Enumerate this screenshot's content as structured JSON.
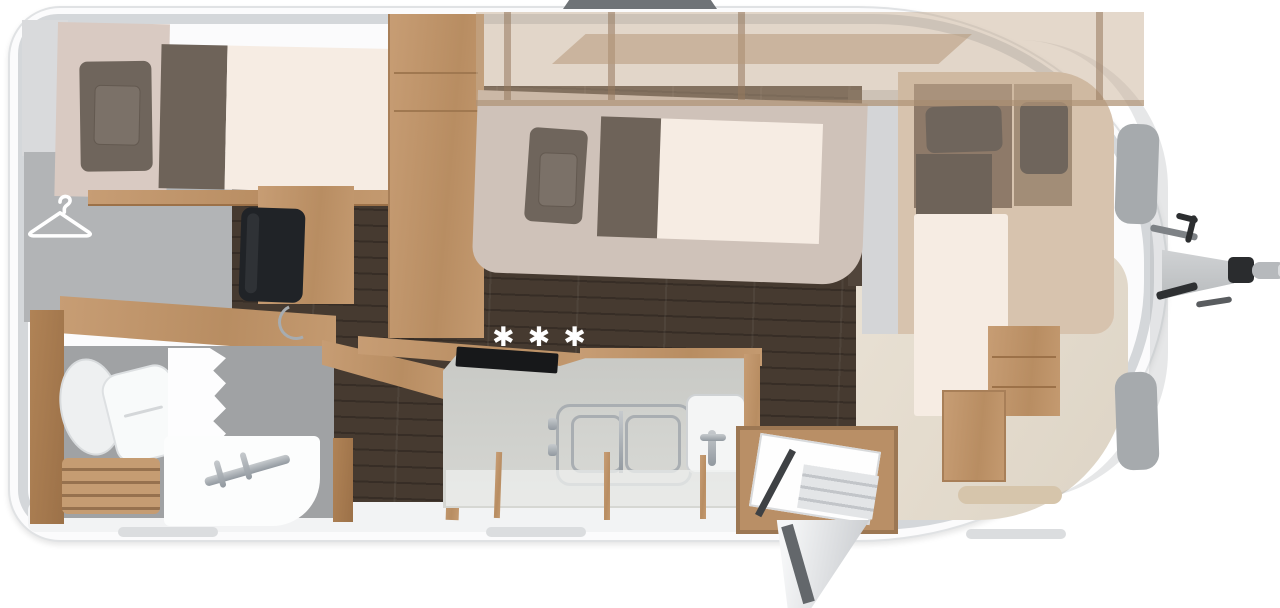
{
  "floorplan": {
    "hob_burners_symbol": "✱✱✱",
    "features": [
      {
        "id": "rear-single-bed",
        "label": "rear single bed with pillow and duvet"
      },
      {
        "id": "wardrobe",
        "label": "wardrobe marked with hanger symbol"
      },
      {
        "id": "tv",
        "label": "flat tv on sideboard"
      },
      {
        "id": "vanity",
        "label": "vanity / dressing table with tap"
      },
      {
        "id": "toilet",
        "label": "swivel toilet"
      },
      {
        "id": "shower",
        "label": "shower with folding glass door"
      },
      {
        "id": "washbasin",
        "label": "washbasin with tap"
      },
      {
        "id": "kitchen",
        "label": "kitchen block with 3-burner hob, grate and sink"
      },
      {
        "id": "center-double-bed",
        "label": "centre bed with pillow and duvet"
      },
      {
        "id": "overhead-lockers",
        "label": "overhead lockers / drop-down bunk (translucent)"
      },
      {
        "id": "front-bed",
        "label": "front transverse bed with two pillows"
      },
      {
        "id": "entrance-door",
        "label": "entrance door shown open with step"
      },
      {
        "id": "tow-hitch",
        "label": "tow hitch / drawbar with coupling"
      }
    ],
    "colors": {
      "body": "#fbfbfc",
      "wall_gray": "#d2d4d6",
      "wood": "#bf9668",
      "floor_dark": "#463a30",
      "floor_front_beige": "#e8e0d3",
      "mattress_cream": "#f6ece3",
      "bedding_dark": "#6e6359",
      "pillow_dark": "#6f655c",
      "counter_gray": "#c7c8c4",
      "hob_black": "#17181a",
      "chrome": "#a8adb1",
      "platform_tan": "#d7c3ae",
      "window_gray": "#a6aaad"
    }
  }
}
